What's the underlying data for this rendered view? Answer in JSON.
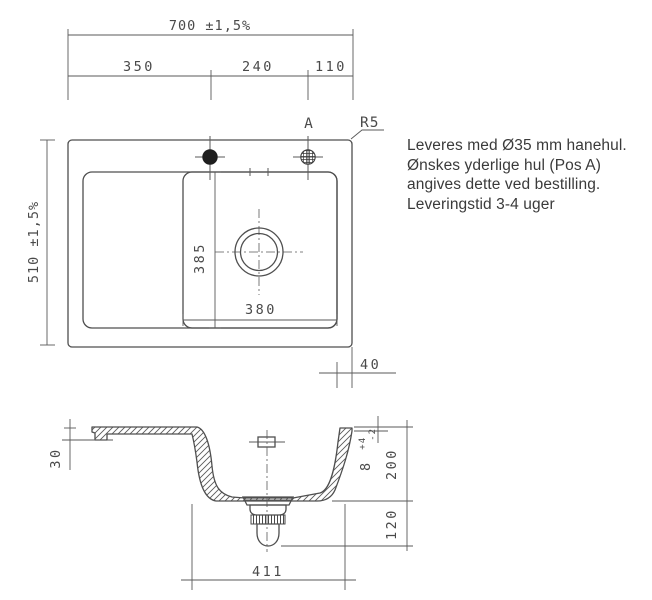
{
  "drawing": {
    "top_view": {
      "dims": {
        "width_total": "700 ±1,5%",
        "height_total": "510 ±1,5%",
        "seg_left": "350",
        "seg_mid": "240",
        "seg_right": "110",
        "bowl_depth": "385",
        "bowl_width": "380",
        "right_offset": "40"
      },
      "labels": {
        "pos_a": "A",
        "corner_radius": "R5"
      }
    },
    "section_view": {
      "dims": {
        "edge_height": "30",
        "rim_thickness": "8",
        "rim_tol_plus": "+4",
        "rim_tol_minus": "-2",
        "bowl_depth": "200",
        "drain_clearance": "120",
        "bowl_bottom_width": "411"
      }
    }
  },
  "note": {
    "lines": [
      "Leveres med Ø35 mm hanehul.",
      "Ønskes yderlige hul (Pos A)",
      "angives dette ved bestilling.",
      "Leveringstid 3-4 uger"
    ]
  },
  "colors": {
    "line": "#4f4f4f",
    "note_text": "#3a3a3a",
    "hole_fill": "#1f1f1f",
    "background": "#ffffff"
  }
}
